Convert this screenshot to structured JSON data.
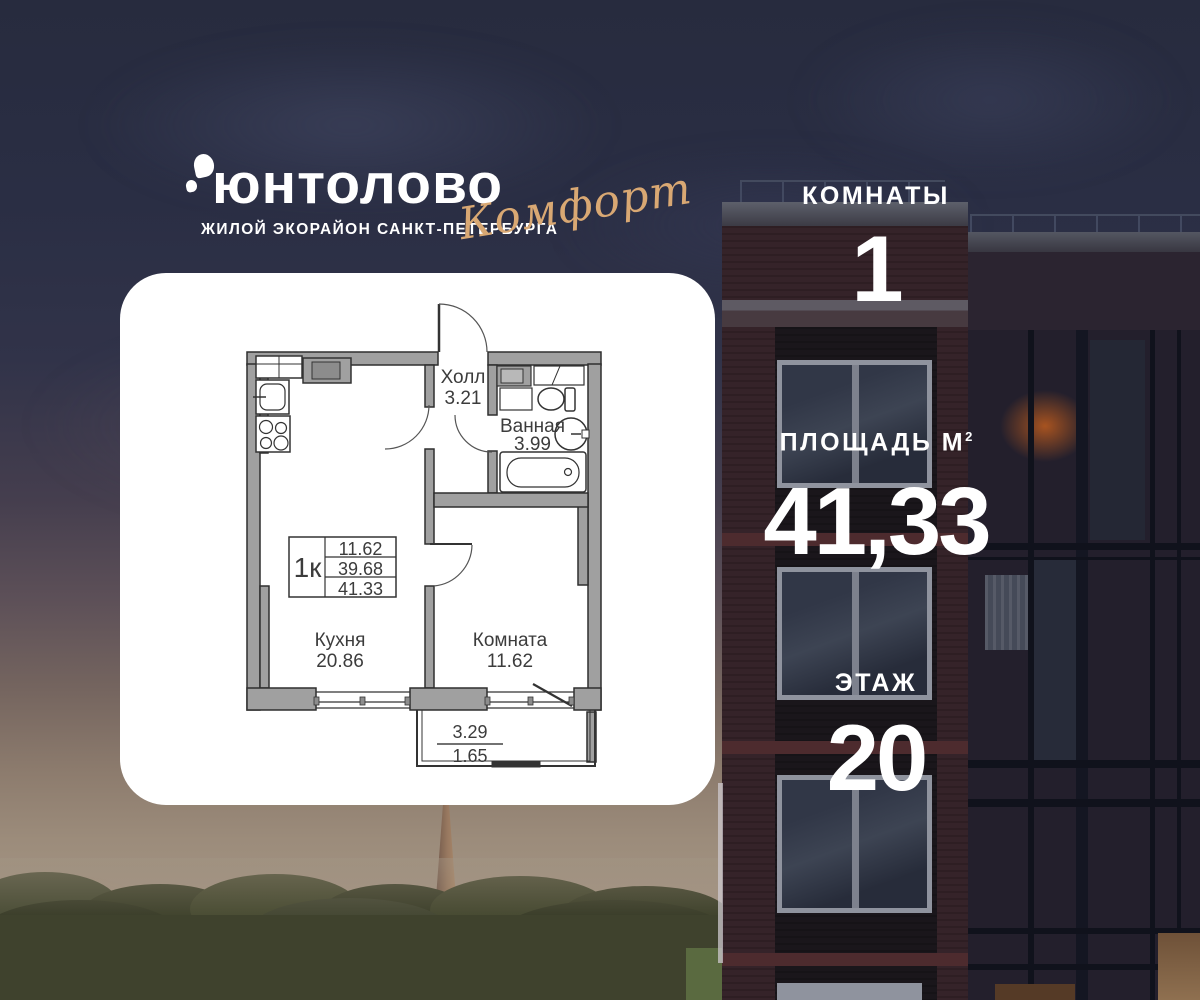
{
  "brand": {
    "logo_text": "юнтолово",
    "logo_subtitle": "ЖИЛОЙ ЭКОРАЙОН САНКТ-ПЕТЕРБУРГА",
    "logo_badge": "Комфорт",
    "badge_color": "#d9a873"
  },
  "info_panel": {
    "rooms_label": "КОМНАТЫ",
    "rooms_value": "1",
    "area_label": "ПЛОЩАДЬ М",
    "area_superscript": "2",
    "area_value": "41,33",
    "floor_label": "ЭТАЖ",
    "floor_value": "20",
    "text_color": "#ffffff"
  },
  "floorplan": {
    "rooms": [
      {
        "name": "Холл",
        "area": "3.21"
      },
      {
        "name": "Ванная",
        "area": "3.99"
      },
      {
        "name": "Кухня",
        "area": "20.86"
      },
      {
        "name": "Комната",
        "area": "11.62"
      }
    ],
    "summary_table": {
      "type_label": "1к",
      "rows": [
        "11.62",
        "39.68",
        "41.33"
      ]
    },
    "balcony": {
      "area_full": "3.29",
      "area_reduced": "1.65"
    }
  }
}
